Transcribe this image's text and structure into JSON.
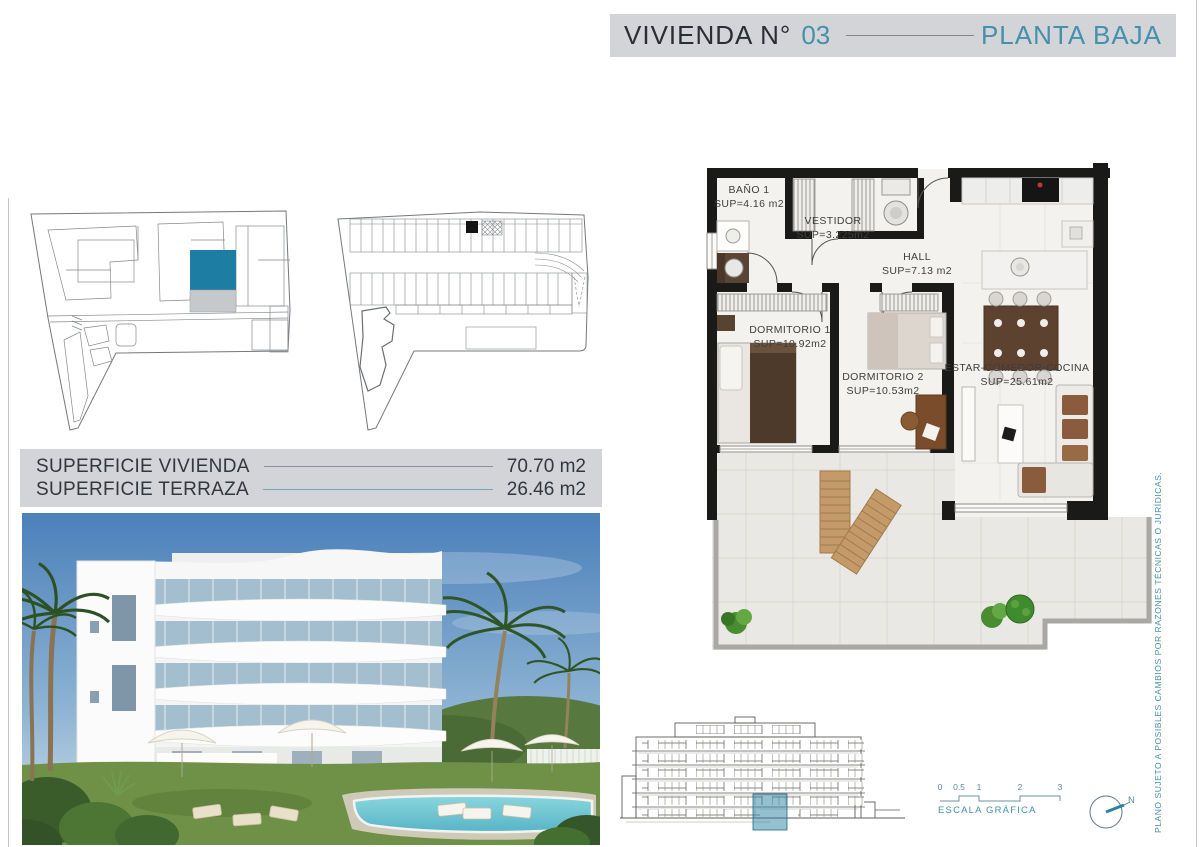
{
  "header": {
    "title_label": "VIVIENDA N°",
    "unit_number": "03",
    "floor_label": "PLANTA BAJA"
  },
  "surfaces": {
    "rows": [
      {
        "label": "SUPERFICIE VIVIENDA",
        "value": "70.70 m2"
      },
      {
        "label": "SUPERFICIE TERRAZA",
        "value": "26.46 m2"
      }
    ]
  },
  "floor_plan": {
    "rooms": [
      {
        "name": "BAÑO 1",
        "area": "SUP=4.16 m2"
      },
      {
        "name": "VESTIDOR",
        "area": "SUP=3.225m2"
      },
      {
        "name": "HALL",
        "area": "SUP=7.13 m2"
      },
      {
        "name": "DORMITORIO 1",
        "area": "SUP=10.92m2"
      },
      {
        "name": "DORMITORIO 2",
        "area": "SUP=10.53m2"
      },
      {
        "name": "ESTAR-COMEDOR-COCINA",
        "area": "SUP=25.61m2"
      }
    ]
  },
  "scale_bar": {
    "ticks": [
      "0",
      "0.5",
      "1",
      "2",
      "3"
    ],
    "label": "ESCALA GRÁFICA"
  },
  "north_arrow": {
    "label": "N"
  },
  "disclaimer": "PLANO SUJETO A POSIBLES CAMBIOS POR RAZONES TÉCNICAS O JURÍDICAS.",
  "colors": {
    "accent_teal": "#4590ab",
    "highlight_teal": "#1e7da2",
    "header_gray": "#d2d4d8",
    "text_dark": "#2b2d35",
    "pool_teal": "#6fc6d4",
    "wall_black": "#1a1a18"
  }
}
